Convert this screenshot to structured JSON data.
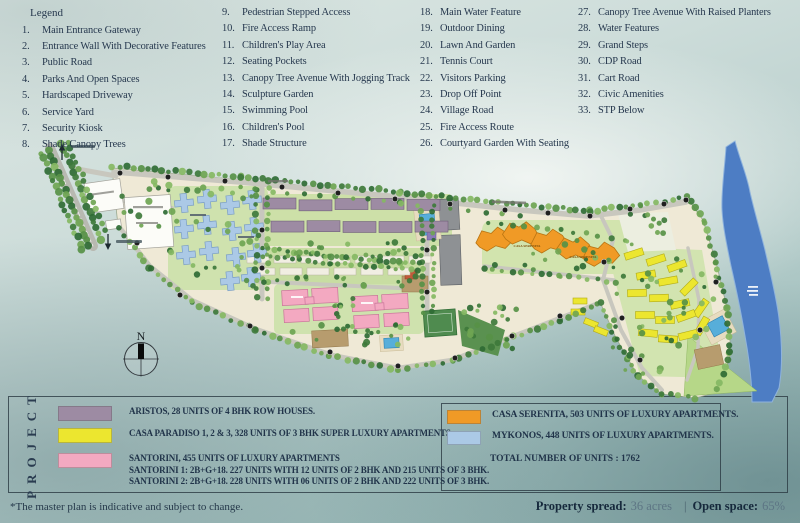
{
  "legend": {
    "title": "Legend",
    "columns": [
      [
        {
          "n": "1.",
          "t": "Main Entrance Gateway"
        },
        {
          "n": "2.",
          "t": "Entrance Wall With Decorative Features"
        },
        {
          "n": "3.",
          "t": "Public Road"
        },
        {
          "n": "4.",
          "t": "Parks And Open Spaces"
        },
        {
          "n": "5.",
          "t": "Hardscaped Driveway"
        },
        {
          "n": "6.",
          "t": "Service Yard"
        },
        {
          "n": "7.",
          "t": "Security Kiosk"
        },
        {
          "n": "8.",
          "t": "Shade Canopy Trees"
        }
      ],
      [
        {
          "n": "9.",
          "t": "Pedestrian Stepped Access"
        },
        {
          "n": "10.",
          "t": "Fire Access Ramp"
        },
        {
          "n": "11.",
          "t": "Children's Play Area"
        },
        {
          "n": "12.",
          "t": "Seating Pockets"
        },
        {
          "n": "13.",
          "t": "Canopy Tree Avenue With Jogging Track"
        },
        {
          "n": "14.",
          "t": "Sculpture Garden"
        },
        {
          "n": "15.",
          "t": "Swimming Pool"
        },
        {
          "n": "16.",
          "t": "Children's  Pool"
        },
        {
          "n": "17.",
          "t": "Shade Structure"
        }
      ],
      [
        {
          "n": "18.",
          "t": "Main Water Feature"
        },
        {
          "n": "19.",
          "t": "Outdoor Dining"
        },
        {
          "n": "20.",
          "t": "Lawn And Garden"
        },
        {
          "n": "21.",
          "t": "Tennis Court"
        },
        {
          "n": "22.",
          "t": "Visitors Parking"
        },
        {
          "n": "23.",
          "t": "Drop Off Point"
        },
        {
          "n": "24.",
          "t": "Village Road"
        },
        {
          "n": "25.",
          "t": "Fire Access Route"
        },
        {
          "n": "26.",
          "t": "Courtyard Garden With Seating"
        }
      ],
      [
        {
          "n": "27.",
          "t": "Canopy Tree Avenue With Raised Planters"
        },
        {
          "n": "28.",
          "t": "Water Features"
        },
        {
          "n": "29.",
          "t": "Grand Steps"
        },
        {
          "n": "30.",
          "t": "CDP Road"
        },
        {
          "n": "31.",
          "t": "Cart Road"
        },
        {
          "n": "32.",
          "t": "Civic Amenities"
        },
        {
          "n": "33.",
          "t": "STP Below"
        }
      ]
    ]
  },
  "map": {
    "compass": "N",
    "serenita_label": "CASA SERENITA",
    "colors": {
      "aristos": "#9d8ba3",
      "casa_paradiso": "#ece62f",
      "santorini": "#f3a9c1",
      "casa_serenita": "#f09a26",
      "mykonos": "#abc9e6",
      "river": "#4d7dc4"
    }
  },
  "project": {
    "heading": "PROJECT",
    "entries_left": [
      {
        "color": "#9d8ba3",
        "line1": "ARISTOS, 28 UNITS OF 4 BHK ROW HOUSES.",
        "line2": "",
        "line3": ""
      },
      {
        "color": "#ece62f",
        "line1": "CASA PARADISO  1, 2 & 3, 328  UNITS OF 3 BHK SUPER LUXURY APARTMENTS.",
        "line2": "",
        "line3": ""
      },
      {
        "color": "#f3a9c1",
        "line1": "SANTORINI, 455 UNITS OF LUXURY APARTMENTS",
        "line2": "SANTORINI 1: 2B+G+18. 227 UNITS WITH 12 UNITS OF 2 BHK AND 215 UNITS OF 3 BHK.",
        "line3": "SANTORINI 2: 2B+G+18. 228 UNITS WITH 06 UNITS OF 2 BHK AND 222 UNITS OF 3 BHK."
      }
    ],
    "entries_right": [
      {
        "color": "#f09a26",
        "line1": "CASA SERENITA, 503 UNITS OF LUXURY APARTMENTS.",
        "line2": "",
        "line3": ""
      },
      {
        "color": "#abc9e6",
        "line1": "MYKONOS, 448 UNITS OF LUXURY APARTMENTS.",
        "line2": "",
        "line3": ""
      }
    ],
    "total": "TOTAL NUMBER OF UNITS : 1762"
  },
  "footer": {
    "disclaimer": "*The master plan is indicative and subject to change.",
    "property_spread_label": "Property spread:",
    "property_spread_value": "36 acres",
    "separator": "|",
    "open_space_label": "Open space:",
    "open_space_value": "65%"
  }
}
